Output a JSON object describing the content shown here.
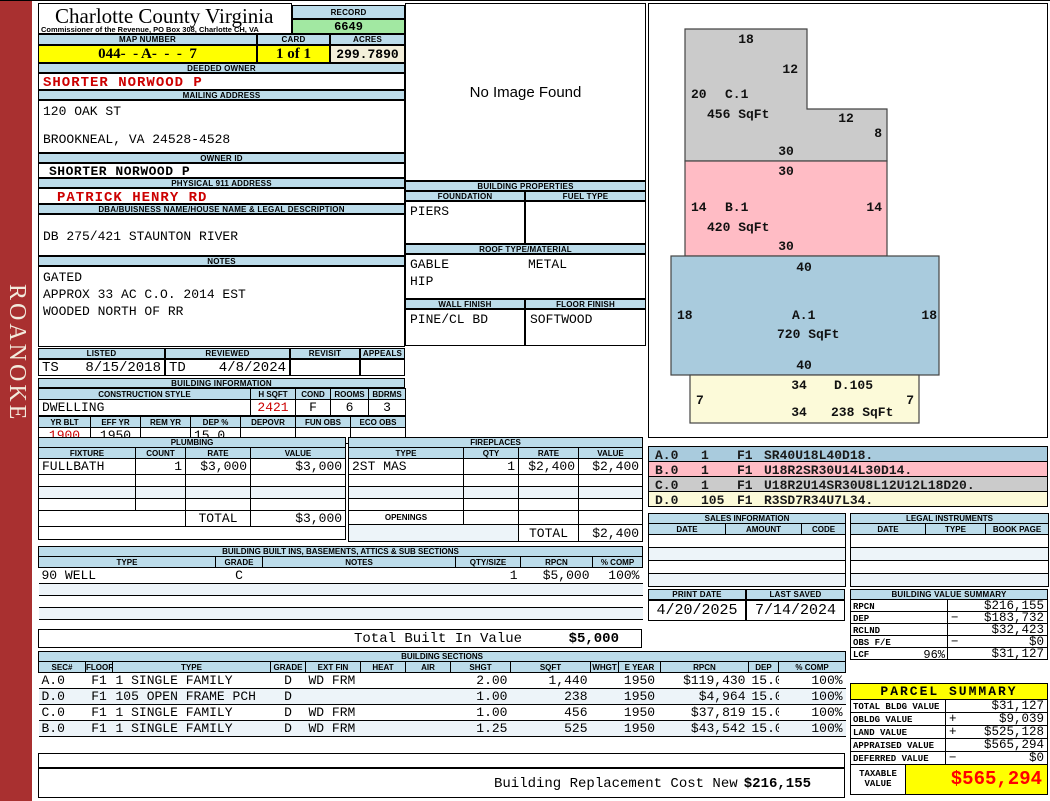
{
  "colors": {
    "header_strip": "#BCDCEA",
    "record_green": "#A2E8A2",
    "highlight_yellow": "#FFFF00",
    "acres_cream": "#F3EFDA",
    "sidebar_red": "#A93030",
    "value_red": "#CC0000",
    "taxable_red": "#FF0000",
    "sketch_a": "#A9CBDD",
    "sketch_b": "#FFBCC5",
    "sketch_c": "#CBCBCB",
    "sketch_d": "#FCFAD9"
  },
  "sidebar": {
    "district": "ROANOKE"
  },
  "header": {
    "county_title": "Charlotte County Virginia",
    "commissioner_line": "Commissioner of the Revenue, PO Box 308, Charlotte CH, VA",
    "record_label": "RECORD",
    "record_number": "6649",
    "map_number_label": "MAP NUMBER",
    "map_number": "044-  - A-  -  -  7",
    "card_label": "CARD",
    "card": "1 of 1",
    "acres_label": "ACRES",
    "acres": "299.7890"
  },
  "owner": {
    "deeded_owner_label": "DEEDED OWNER",
    "deeded_owner": "SHORTER NORWOOD P",
    "mailing_address_label": "MAILING ADDRESS",
    "mailing_address_line1": "120 OAK ST",
    "mailing_address_line2": "BROOKNEAL, VA 24528-4528",
    "owner_id_label": "OWNER ID",
    "owner_id": "SHORTER NORWOOD P",
    "physical_address_label": "PHYSICAL 911 ADDRESS",
    "physical_address": "PATRICK HENRY RD",
    "dba_label": "DBA/BUISNESS NAME/HOUSE NAME & LEGAL DESCRIPTION",
    "legal_description": "DB 275/421 STAUNTON RIVER",
    "notes_label": "NOTES",
    "notes": [
      "GATED",
      "APPROX 33 AC C.O. 2014 EST",
      "WOODED NORTH OF RR"
    ]
  },
  "image_panel": {
    "no_image_text": "No Image Found"
  },
  "review": {
    "listed_label": "LISTED",
    "reviewed_label": "REVIEWED",
    "revisit_label": "REVISIT",
    "appeals_label": "APPEALS",
    "listed_by": "TS",
    "listed_date": "8/15/2018",
    "reviewed_by": "TD",
    "reviewed_date": "4/8/2024",
    "revisit": "",
    "appeals": ""
  },
  "building_information": {
    "title": "BUILDING INFORMATION",
    "style_headers": [
      "CONSTRUCTION STYLE",
      "H SQFT",
      "COND",
      "ROOMS",
      "BDRMS"
    ],
    "construction_style": "DWELLING",
    "h_sqft": "2421",
    "cond": "F",
    "rooms": "6",
    "bdrms": "3",
    "year_headers": [
      "YR BLT",
      "EFF YR",
      "REM YR",
      "DEP %",
      "DEPOVR",
      "FUN OBS",
      "ECO OBS"
    ],
    "yr_blt": "1900",
    "eff_yr": "1950",
    "rem_yr": "",
    "dep_pct": "15.0",
    "depovr": "",
    "fun_obs": "",
    "eco_obs": ""
  },
  "building_properties": {
    "title": "BUILDING PROPERTIES",
    "foundation_label": "FOUNDATION",
    "fuel_type_label": "FUEL TYPE",
    "foundation": "PIERS",
    "fuel_type": "",
    "roof_label": "ROOF TYPE/MATERIAL",
    "roof_type_1": "GABLE",
    "roof_type_2": "HIP",
    "roof_material": "METAL",
    "wall_finish_label": "WALL FINISH",
    "floor_finish_label": "FLOOR FINISH",
    "wall_finish": "PINE/CL BD",
    "floor_finish": "SOFTWOOD"
  },
  "plumbing": {
    "title": "PLUMBING",
    "headers": [
      "FIXTURE",
      "COUNT",
      "RATE",
      "VALUE"
    ],
    "rows": [
      [
        "FULLBATH",
        "1",
        "$3,000",
        "$3,000"
      ]
    ],
    "total_label": "TOTAL",
    "total": "$3,000"
  },
  "fireplaces": {
    "title": "FIREPLACES",
    "headers": [
      "TYPE",
      "QTY",
      "RATE",
      "VALUE"
    ],
    "rows": [
      [
        "2ST MAS",
        "1",
        "$2,400",
        "$2,400"
      ]
    ],
    "openings_label": "OPENINGS",
    "total_label": "TOTAL",
    "total": "$2,400"
  },
  "built_ins": {
    "title": "BUILDING BUILT INS, BASEMENTS, ATTICS & SUB SECTIONS",
    "headers": [
      "TYPE",
      "GRADE",
      "NOTES",
      "QTY/SIZE",
      "RPCN",
      "% COMP"
    ],
    "rows": [
      [
        "90 WELL",
        "C",
        "",
        "1",
        "$5,000",
        "100%"
      ]
    ],
    "total_label": "Total Built In Value",
    "total": "$5,000"
  },
  "building_sections": {
    "title": "BUILDING SECTIONS",
    "headers": [
      "SEC#",
      "FLOOR",
      "TYPE",
      "GRADE",
      "EXT FIN",
      "HEAT",
      "AIR",
      "SHGT",
      "SQFT",
      "WHGT",
      "E YEAR",
      "RPCN",
      "DEP",
      "% COMP"
    ],
    "rows": [
      [
        "A.0",
        "F1",
        "1 SINGLE FAMILY",
        "D",
        "WD FRM",
        "",
        "",
        "2.00",
        "1,440",
        "",
        "1950",
        "$119,430",
        "15.0",
        "100%"
      ],
      [
        "D.0",
        "F1",
        "105 OPEN FRAME PCH",
        "D",
        "",
        "",
        "",
        "1.00",
        "238",
        "",
        "1950",
        "$4,964",
        "15.0",
        "100%"
      ],
      [
        "C.0",
        "F1",
        "1 SINGLE FAMILY",
        "D",
        "WD FRM",
        "",
        "",
        "1.00",
        "456",
        "",
        "1950",
        "$37,819",
        "15.0",
        "100%"
      ],
      [
        "B.0",
        "F1",
        "1 SINGLE FAMILY",
        "D",
        "WD FRM",
        "",
        "",
        "1.25",
        "525",
        "",
        "1950",
        "$43,542",
        "15.0",
        "100%"
      ]
    ],
    "replacement_label": "Building Replacement Cost New",
    "replacement_value": "$216,155"
  },
  "sketch": {
    "c1": {
      "name": "C.1",
      "sqft": "456 SqFt",
      "top": "18",
      "right_upper": "12",
      "left": "20",
      "step": "12",
      "right_lower": "8",
      "bottom": "30"
    },
    "b1": {
      "name": "B.1",
      "sqft": "420 SqFt",
      "top": "30",
      "left": "14",
      "right": "14",
      "bottom": "30"
    },
    "a1": {
      "name": "A.1",
      "sqft": "720 SqFt",
      "top": "40",
      "left": "18",
      "right": "18",
      "bottom": "40"
    },
    "d105": {
      "name": "D.105",
      "sqft": "238 SqFt",
      "top": "34",
      "left": "7",
      "right": "7",
      "bottom": "34"
    }
  },
  "section_codes": {
    "rows": [
      {
        "sec": "A.0",
        "num": "1",
        "floor": "F1",
        "code": "SR40U18L40D18."
      },
      {
        "sec": "B.0",
        "num": "1",
        "floor": "F1",
        "code": "U18R2SR30U14L30D14."
      },
      {
        "sec": "C.0",
        "num": "1",
        "floor": "F1",
        "code": "U18R2U14SR30U8L12U12L18D20."
      },
      {
        "sec": "D.0",
        "num": "105",
        "floor": "F1",
        "code": "R3SD7R34U7L34."
      }
    ]
  },
  "sales_information": {
    "title": "SALES INFORMATION",
    "headers": [
      "DATE",
      "AMOUNT",
      "CODE"
    ]
  },
  "legal_instruments": {
    "title": "LEGAL INSTRUMENTS",
    "headers": [
      "DATE",
      "TYPE",
      "BOOK PAGE"
    ]
  },
  "print_info": {
    "print_date_label": "PRINT DATE",
    "print_date": "4/20/2025",
    "last_saved_label": "LAST SAVED",
    "last_saved": "7/14/2024"
  },
  "building_value_summary": {
    "title": "BUILDING VALUE SUMMARY",
    "rows": [
      {
        "label": "RPCN",
        "pct": "",
        "op": "",
        "value": "$216,155"
      },
      {
        "label": "DEP",
        "pct": "",
        "op": "−",
        "value": "$183,732"
      },
      {
        "label": "RCLND",
        "pct": "",
        "op": "",
        "value": "$32,423"
      },
      {
        "label": "OBS F/E",
        "pct": "",
        "op": "−",
        "value": "$0"
      },
      {
        "label": "LCF",
        "pct": "96%",
        "op": "",
        "value": "$31,127"
      }
    ]
  },
  "parcel_summary": {
    "title": "PARCEL SUMMARY",
    "rows": [
      {
        "label": "TOTAL BLDG VALUE",
        "op": "",
        "value": "$31,127"
      },
      {
        "label": "OBLDG VALUE",
        "op": "+",
        "value": "$9,039"
      },
      {
        "label": "LAND VALUE",
        "op": "+",
        "value": "$525,128"
      },
      {
        "label": "APPRAISED VALUE",
        "op": "",
        "value": "$565,294"
      },
      {
        "label": "DEFERRED VALUE",
        "op": "−",
        "value": "$0"
      }
    ],
    "taxable_label": "TAXABLE VALUE",
    "taxable_value": "$565,294"
  }
}
